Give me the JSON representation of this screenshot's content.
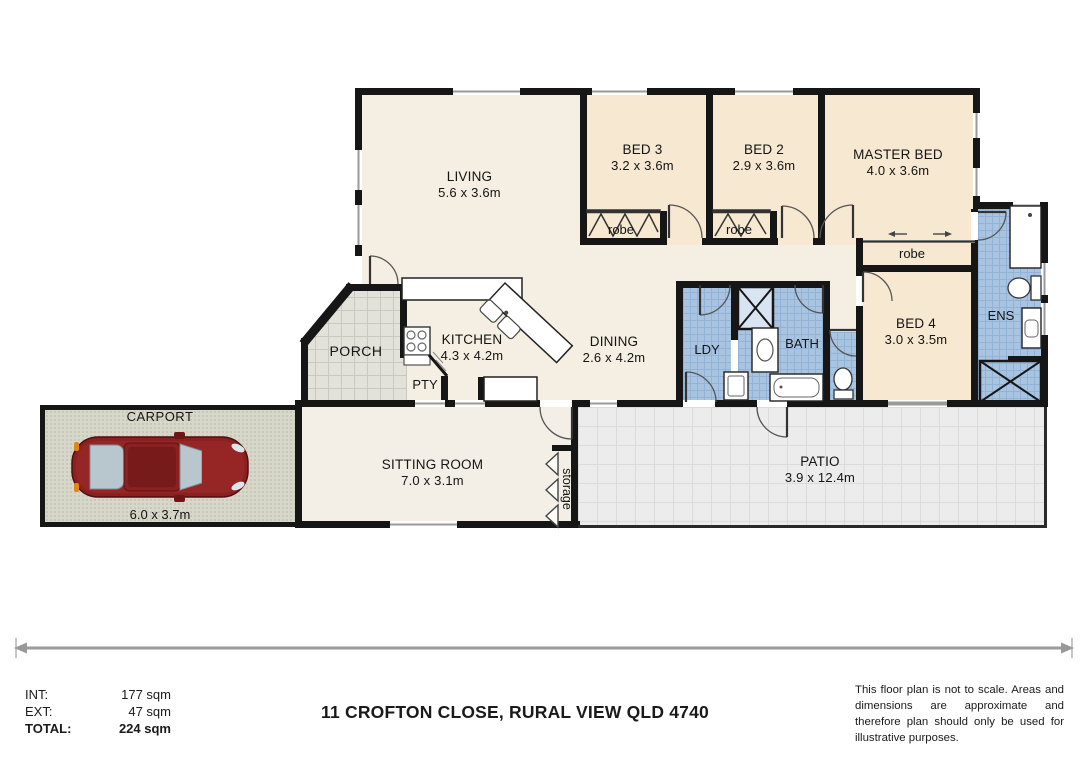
{
  "title": "11 CROFTON CLOSE, RURAL VIEW QLD 4740",
  "areas": {
    "int_label": "INT:",
    "int_value": "177 sqm",
    "ext_label": "EXT:",
    "ext_value": "47 sqm",
    "total_label": "TOTAL:",
    "total_value": "224 sqm"
  },
  "disclaimer": "This floor plan is not to scale. Areas and dimensions are approximate and therefore plan should only be used for illustrative purposes.",
  "rooms": {
    "living": {
      "name": "LIVING",
      "dims": "5.6 x 3.6m"
    },
    "bed3": {
      "name": "BED 3",
      "dims": "3.2 x 3.6m"
    },
    "bed2": {
      "name": "BED 2",
      "dims": "2.9 x 3.6m"
    },
    "master": {
      "name": "MASTER BED",
      "dims": "4.0 x 3.6m"
    },
    "bed4": {
      "name": "BED 4",
      "dims": "3.0 x 3.5m"
    },
    "kitchen": {
      "name": "KITCHEN",
      "dims": "4.3 x 4.2m"
    },
    "dining": {
      "name": "DINING",
      "dims": "2.6 x 4.2m"
    },
    "porch": {
      "name": "PORCH"
    },
    "pty": {
      "name": "PTY"
    },
    "ldy": {
      "name": "LDY"
    },
    "bath": {
      "name": "BATH"
    },
    "ens": {
      "name": "ENS"
    },
    "carport": {
      "name": "CARPORT",
      "dims": "6.0 x 3.7m"
    },
    "sitting": {
      "name": "SITTING ROOM",
      "dims": "7.0 x 3.1m"
    },
    "storage": {
      "name": "storage"
    },
    "patio": {
      "name": "PATIO",
      "dims": "3.9 x 12.4m"
    },
    "robe": {
      "name": "robe"
    }
  },
  "colors": {
    "wall": "#161616",
    "room_cream": "#f5eee2",
    "bedroom_cream": "#f6e8d1",
    "wet_area_blue": "#a9c4e1",
    "porch_grey": "#e2e2da",
    "patio_grey": "#ececec",
    "carport_grey": "#d8d8ca",
    "car_red": "#8a2020"
  }
}
